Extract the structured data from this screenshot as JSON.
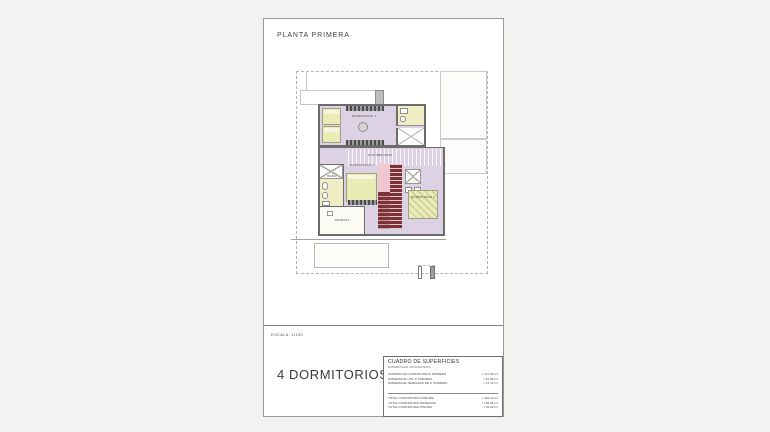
{
  "page": {
    "title": "PLANTA PRIMERA",
    "scale_label": "ESCALA: 1/150",
    "caption": "4 DORMITORIOS"
  },
  "plan": {
    "rooms": {
      "dormitorio1": "DORMITORIO 1",
      "distribuidor": "DISTRIBUIDOR",
      "dormitorio2": "DORMITORIO 2",
      "dormitorio3": "DORMITORIO 3",
      "bano": "BAÑO",
      "terraza": "TERRAZA"
    },
    "colors": {
      "floor": "#ddd2e4",
      "wet_floor": "#f1eec5",
      "bed": "#e9ecb4",
      "wall": "#6d6d6d",
      "stair_dark": "#7c3136",
      "stair_pink": "#f0c8cf"
    }
  },
  "surfaces_table": {
    "title": "CUADRO DE SUPERFICIES",
    "subtitle": "SUPERFICIES CONSTRUIDAS",
    "rows": [
      {
        "label": "SUPERFICIE CONSTRUIDA P. PRIMERA",
        "value": "= 117,80 m²"
      },
      {
        "label": "SUPERFICIE ÚTIL P. PRIMERA",
        "value": "= 91,80 m²"
      },
      {
        "label": "SUPERFICIE TERRAZAS DE P. PRIMERA",
        "value": "= 13,15 m²"
      }
    ],
    "totals": [
      {
        "label": "TOTAL CONSTRUIDA VIVIENDA",
        "value": "= 246,10 m²"
      },
      {
        "label": "TOTAL CONSTRUIDA TERRAZAS",
        "value": "= 138,05 m²"
      },
      {
        "label": "TOTAL CONSTRUIDA PISCINA",
        "value": "= 32,00 m²"
      }
    ]
  }
}
